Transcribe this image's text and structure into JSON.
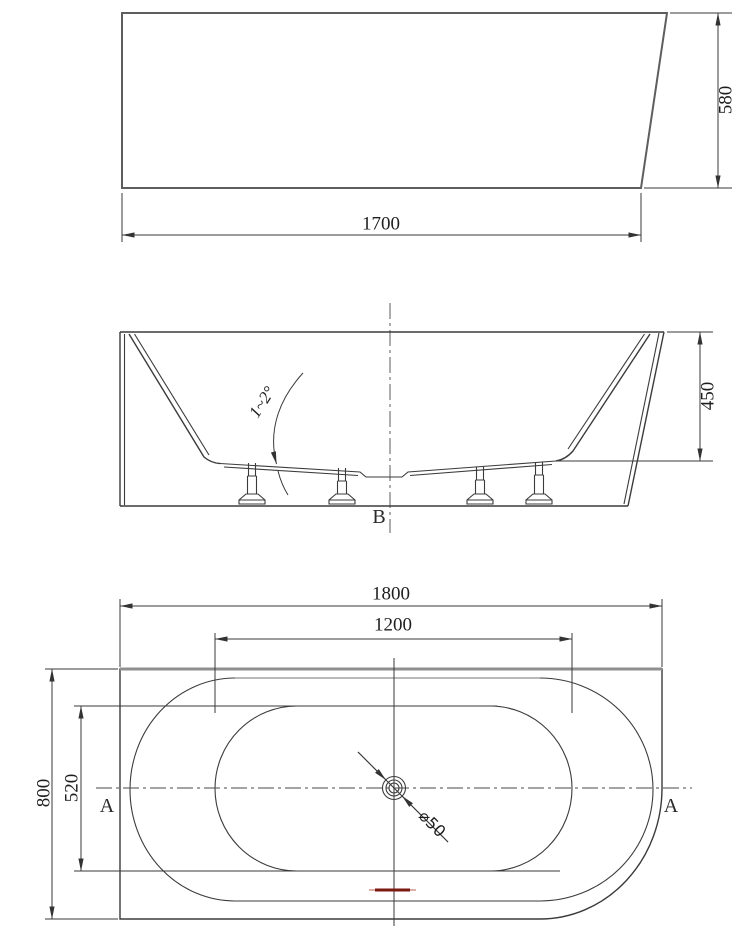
{
  "drawing": {
    "side_view": {
      "width_dim": "1700",
      "height_dim": "580"
    },
    "section_view": {
      "marker": "B",
      "depth_dim": "450",
      "slope_note": "1~2°"
    },
    "plan_view": {
      "length_dim": "1800",
      "basin_length_dim": "1200",
      "width_dim": "800",
      "basin_width_dim": "520",
      "drain_dim": "⌀50",
      "section_marker_left": "A",
      "section_marker_right": "A"
    }
  },
  "colors": {
    "background": "#ffffff",
    "outline": "#3b3b3b",
    "light_outline": "#8f8f8f",
    "dimension": "#3a3a3a",
    "text": "#1e1e1e",
    "red_marker": "#7c1a12"
  }
}
